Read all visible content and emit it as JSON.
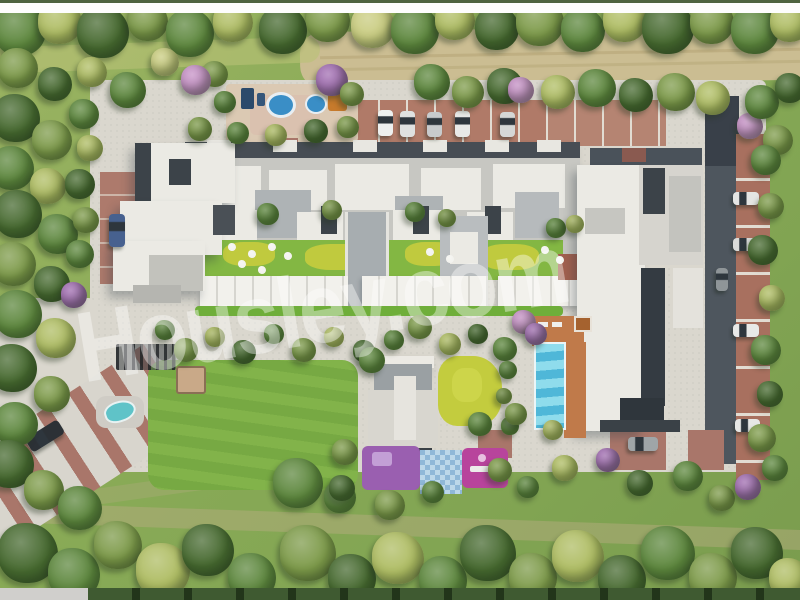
{
  "watermark": {
    "text": "Housley.com",
    "color": "rgba(255,255,255,0.40)"
  },
  "scene": {
    "kind": "3d-aerial-site-plan-rendering",
    "subject": "residential apartment complex with inner courtyards, swimming pool, playgrounds, parking rows and tree belt",
    "palette": {
      "grass": "#8aab57",
      "pavement": "#dad7ce",
      "brick": "#a8705f",
      "asphalt": "#4e565e",
      "roof_white": "#ebeae4",
      "roof_gray": "#c7c7c2",
      "roof_mid": "#a7adb0",
      "roof_dark": "#3c4349",
      "lawn": "#7fb148",
      "chartreuse": "#c3cc3e",
      "pool_water": "#7ed3e6",
      "pool_wave": "#3fa9cc",
      "deck": "#c07a4a",
      "play_purple": "#9a5fb0",
      "play_magenta": "#b8449c",
      "dirt": "#cbbd92",
      "water_small": "#5fc3c8",
      "splash_blue": "#3a8ec6",
      "equip_orange": "#c67a2c",
      "tree_dark": "#46692f",
      "tree_mid": "#5d873d",
      "tree_olive": "#7d9a49",
      "tree_yellow": "#aebc62",
      "tree_pale": "#c8cb7e",
      "tree_pink": "#c48fc4",
      "tree_purple": "#a06cb0",
      "dot_white": "#f3f3ef",
      "top_bar": "#fdfdfd",
      "bottom_strip_left": "#d0cfcc",
      "bottom_strip_green": "#3f5a31"
    },
    "trees": [
      [
        20,
        30,
        26,
        "tree_mid"
      ],
      [
        60,
        22,
        22,
        "tree_yellow"
      ],
      [
        103,
        32,
        26,
        "tree_dark"
      ],
      [
        148,
        21,
        20,
        "tree_olive"
      ],
      [
        190,
        33,
        24,
        "tree_mid"
      ],
      [
        233,
        22,
        20,
        "tree_yellow"
      ],
      [
        283,
        30,
        24,
        "tree_dark"
      ],
      [
        328,
        20,
        22,
        "tree_olive"
      ],
      [
        373,
        26,
        22,
        "tree_pale"
      ],
      [
        415,
        30,
        24,
        "tree_mid"
      ],
      [
        455,
        20,
        20,
        "tree_yellow"
      ],
      [
        497,
        28,
        22,
        "tree_dark"
      ],
      [
        540,
        22,
        24,
        "tree_olive"
      ],
      [
        583,
        30,
        22,
        "tree_mid"
      ],
      [
        625,
        20,
        22,
        "tree_yellow"
      ],
      [
        668,
        28,
        26,
        "tree_dark"
      ],
      [
        712,
        22,
        22,
        "tree_olive"
      ],
      [
        755,
        30,
        24,
        "tree_mid"
      ],
      [
        790,
        22,
        20,
        "tree_yellow"
      ],
      [
        432,
        82,
        18,
        "tree_mid"
      ],
      [
        468,
        92,
        16,
        "tree_olive"
      ],
      [
        505,
        86,
        18,
        "tree_dark"
      ],
      [
        521,
        90,
        13,
        "tree_pink"
      ],
      [
        558,
        92,
        17,
        "tree_yellow"
      ],
      [
        597,
        88,
        19,
        "tree_mid"
      ],
      [
        636,
        95,
        17,
        "tree_dark"
      ],
      [
        676,
        92,
        19,
        "tree_olive"
      ],
      [
        713,
        98,
        17,
        "tree_yellow"
      ],
      [
        750,
        126,
        13,
        "tree_pink"
      ],
      [
        762,
        102,
        17,
        "tree_mid"
      ],
      [
        790,
        88,
        15,
        "tree_dark"
      ],
      [
        778,
        140,
        15,
        "tree_olive"
      ],
      [
        18,
        68,
        20,
        "tree_olive"
      ],
      [
        55,
        84,
        17,
        "tree_dark"
      ],
      [
        92,
        72,
        15,
        "tree_yellow"
      ],
      [
        128,
        90,
        18,
        "tree_mid"
      ],
      [
        165,
        62,
        14,
        "tree_pale"
      ],
      [
        215,
        74,
        13,
        "tree_olive"
      ],
      [
        196,
        80,
        15,
        "tree_pink"
      ],
      [
        332,
        80,
        16,
        "tree_purple"
      ],
      [
        225,
        102,
        11,
        "tree_mid"
      ],
      [
        352,
        94,
        12,
        "tree_olive"
      ],
      [
        200,
        129,
        12,
        "tree_olive"
      ],
      [
        238,
        133,
        11,
        "tree_mid"
      ],
      [
        276,
        135,
        11,
        "tree_yellow"
      ],
      [
        316,
        131,
        12,
        "tree_dark"
      ],
      [
        348,
        127,
        11,
        "tree_olive"
      ],
      [
        16,
        118,
        24,
        "tree_dark"
      ],
      [
        52,
        140,
        20,
        "tree_olive"
      ],
      [
        12,
        168,
        22,
        "tree_mid"
      ],
      [
        48,
        186,
        18,
        "tree_yellow"
      ],
      [
        18,
        214,
        24,
        "tree_dark"
      ],
      [
        58,
        234,
        20,
        "tree_mid"
      ],
      [
        14,
        264,
        22,
        "tree_olive"
      ],
      [
        52,
        284,
        18,
        "tree_dark"
      ],
      [
        74,
        295,
        13,
        "tree_purple"
      ],
      [
        18,
        314,
        24,
        "tree_mid"
      ],
      [
        56,
        338,
        20,
        "tree_yellow"
      ],
      [
        13,
        368,
        24,
        "tree_dark"
      ],
      [
        52,
        394,
        18,
        "tree_olive"
      ],
      [
        16,
        424,
        22,
        "tree_mid"
      ],
      [
        10,
        464,
        24,
        "tree_dark"
      ],
      [
        44,
        490,
        20,
        "tree_olive"
      ],
      [
        80,
        508,
        22,
        "tree_mid"
      ],
      [
        84,
        114,
        15,
        "tree_mid"
      ],
      [
        90,
        148,
        13,
        "tree_yellow"
      ],
      [
        80,
        184,
        15,
        "tree_dark"
      ],
      [
        86,
        220,
        13,
        "tree_olive"
      ],
      [
        80,
        254,
        14,
        "tree_mid"
      ],
      [
        28,
        553,
        30,
        "tree_dark"
      ],
      [
        74,
        574,
        26,
        "tree_mid"
      ],
      [
        118,
        545,
        24,
        "tree_olive"
      ],
      [
        163,
        570,
        27,
        "tree_yellow"
      ],
      [
        208,
        550,
        26,
        "tree_dark"
      ],
      [
        252,
        577,
        24,
        "tree_mid"
      ],
      [
        298,
        483,
        25,
        "tree_mid"
      ],
      [
        308,
        553,
        28,
        "tree_olive"
      ],
      [
        352,
        578,
        24,
        "tree_dark"
      ],
      [
        398,
        558,
        26,
        "tree_yellow"
      ],
      [
        443,
        580,
        24,
        "tree_mid"
      ],
      [
        488,
        553,
        28,
        "tree_dark"
      ],
      [
        533,
        577,
        24,
        "tree_olive"
      ],
      [
        578,
        556,
        26,
        "tree_yellow"
      ],
      [
        622,
        579,
        24,
        "tree_dark"
      ],
      [
        668,
        553,
        27,
        "tree_mid"
      ],
      [
        713,
        577,
        24,
        "tree_olive"
      ],
      [
        757,
        553,
        26,
        "tree_dark"
      ],
      [
        789,
        578,
        20,
        "tree_yellow"
      ],
      [
        340,
        497,
        16,
        "tree_mid"
      ],
      [
        390,
        505,
        15,
        "tree_olive"
      ],
      [
        165,
        330,
        10,
        "tree_mid"
      ],
      [
        186,
        350,
        12,
        "tree_olive"
      ],
      [
        215,
        337,
        10,
        "tree_yellow"
      ],
      [
        244,
        352,
        12,
        "tree_dark"
      ],
      [
        274,
        334,
        10,
        "tree_mid"
      ],
      [
        304,
        350,
        12,
        "tree_olive"
      ],
      [
        334,
        337,
        10,
        "tree_yellow"
      ],
      [
        364,
        351,
        11,
        "tree_dark"
      ],
      [
        394,
        340,
        10,
        "tree_mid"
      ],
      [
        420,
        327,
        12,
        "tree_olive"
      ],
      [
        450,
        344,
        11,
        "tree_yellow"
      ],
      [
        478,
        334,
        10,
        "tree_dark"
      ],
      [
        505,
        349,
        12,
        "tree_mid"
      ],
      [
        524,
        322,
        12,
        "tree_pink"
      ],
      [
        536,
        334,
        11,
        "tree_purple"
      ],
      [
        508,
        370,
        9,
        "tree_mid"
      ],
      [
        504,
        396,
        8,
        "tree_olive"
      ],
      [
        510,
        426,
        9,
        "tree_mid"
      ],
      [
        372,
        360,
        13,
        "tree_mid"
      ],
      [
        480,
        424,
        12,
        "tree_mid"
      ],
      [
        516,
        414,
        11,
        "tree_olive"
      ],
      [
        553,
        430,
        10,
        "tree_yellow"
      ],
      [
        345,
        452,
        13,
        "tree_olive"
      ],
      [
        342,
        488,
        13,
        "tree_dark"
      ],
      [
        433,
        492,
        11,
        "tree_mid"
      ],
      [
        500,
        470,
        12,
        "tree_olive"
      ],
      [
        528,
        487,
        11,
        "tree_mid"
      ],
      [
        565,
        468,
        13,
        "tree_yellow"
      ],
      [
        608,
        460,
        12,
        "tree_purple"
      ],
      [
        640,
        483,
        13,
        "tree_dark"
      ],
      [
        688,
        476,
        15,
        "tree_mid"
      ],
      [
        722,
        498,
        13,
        "tree_olive"
      ],
      [
        748,
        487,
        13,
        "tree_purple"
      ],
      [
        766,
        160,
        15,
        "tree_mid"
      ],
      [
        771,
        206,
        13,
        "tree_olive"
      ],
      [
        763,
        250,
        15,
        "tree_dark"
      ],
      [
        772,
        298,
        13,
        "tree_yellow"
      ],
      [
        766,
        350,
        15,
        "tree_mid"
      ],
      [
        770,
        394,
        13,
        "tree_dark"
      ],
      [
        762,
        438,
        14,
        "tree_olive"
      ],
      [
        775,
        468,
        13,
        "tree_mid"
      ],
      [
        268,
        214,
        11,
        "tree_mid"
      ],
      [
        332,
        210,
        10,
        "tree_olive"
      ],
      [
        415,
        212,
        10,
        "tree_mid"
      ],
      [
        447,
        218,
        9,
        "tree_olive"
      ],
      [
        556,
        228,
        10,
        "tree_mid"
      ],
      [
        575,
        224,
        9,
        "tree_yellow"
      ],
      [
        232,
        247,
        4,
        "dot_white"
      ],
      [
        252,
        254,
        4,
        "dot_white"
      ],
      [
        272,
        247,
        4,
        "dot_white"
      ],
      [
        288,
        256,
        4,
        "dot_white"
      ],
      [
        242,
        264,
        4,
        "dot_white"
      ],
      [
        262,
        270,
        4,
        "dot_white"
      ],
      [
        430,
        252,
        4,
        "dot_white"
      ],
      [
        450,
        259,
        4,
        "dot_white"
      ],
      [
        545,
        250,
        4,
        "dot_white"
      ],
      [
        560,
        260,
        4,
        "dot_white"
      ]
    ],
    "cars": [
      [
        378,
        110,
        15,
        26,
        "#eef0ef",
        0
      ],
      [
        400,
        111,
        15,
        26,
        "#dfe1e0",
        0
      ],
      [
        427,
        112,
        15,
        25,
        "#c8cbcd",
        0
      ],
      [
        455,
        111,
        15,
        26,
        "#e8e9e7",
        0
      ],
      [
        500,
        112,
        15,
        25,
        "#d5d7d6",
        0
      ],
      [
        109,
        214,
        16,
        33,
        "#47618f",
        0
      ],
      [
        26,
        428,
        38,
        16,
        "#2c3136",
        -32
      ],
      [
        628,
        437,
        30,
        14,
        "#9fa5a8",
        0
      ],
      [
        733,
        192,
        26,
        13,
        "#e4e5e3",
        0
      ],
      [
        733,
        238,
        26,
        13,
        "#dadbd9",
        0
      ],
      [
        716,
        268,
        12,
        23,
        "#8f9598",
        0
      ],
      [
        733,
        324,
        26,
        13,
        "#e8e9e7",
        0
      ],
      [
        735,
        419,
        25,
        13,
        "#e6e7e5",
        0
      ]
    ]
  }
}
